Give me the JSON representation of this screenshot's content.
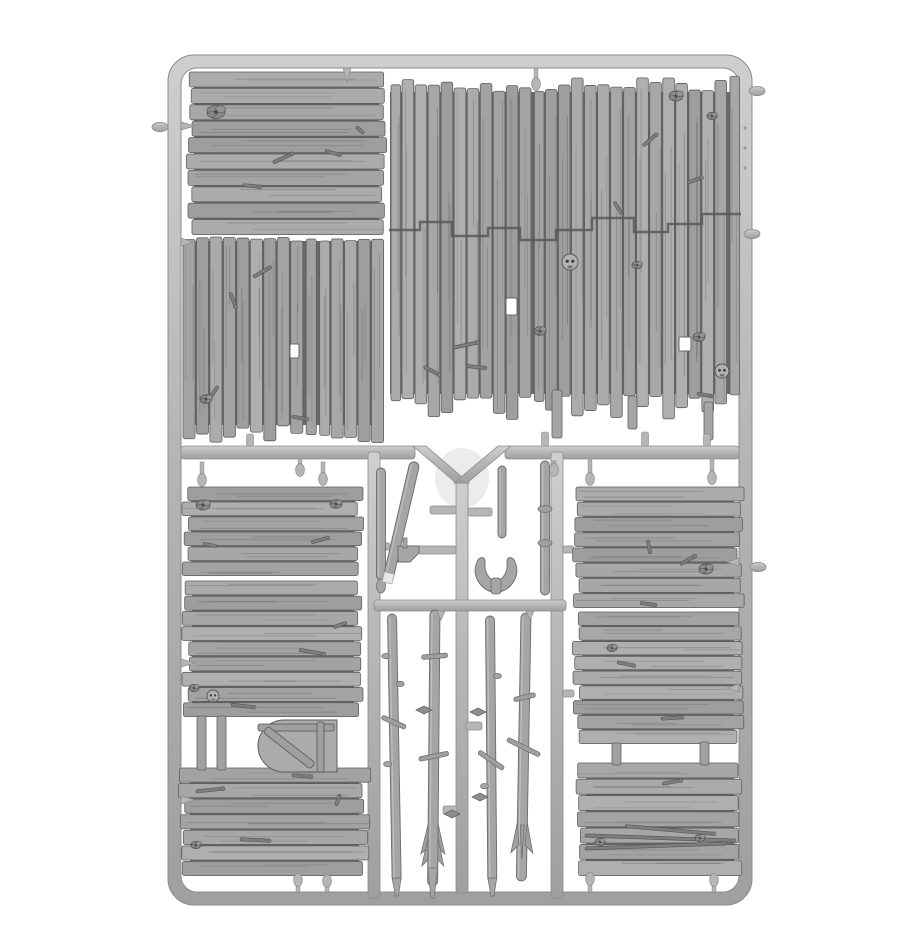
{
  "meta": {
    "alt": "Grey plastic model sprue containing weathered wooden plank wall panels, a round-top door and branch stick parts",
    "width": 920,
    "height": 950
  },
  "palette": {
    "bg": "#ffffff",
    "metal": "#b6b6b6",
    "metal_hi": "#cfcfcf",
    "metal_lo": "#9f9f9f",
    "metal_stroke": "#8b8b8b",
    "plank": "#a7a7a7",
    "plank_dark": "#696969",
    "seam": "#585858",
    "grain": "#3f3f3f",
    "stick": "#a5a5a5",
    "stick_stroke": "#6b6b6b",
    "detail": "#8c8c8c",
    "detail_stroke": "#545454",
    "hole": "#ffffff",
    "mold_mark": "#e2e2e2",
    "skull": "#b2b2b2"
  },
  "frame": {
    "x": 168,
    "y": 55,
    "w": 584,
    "h": 850,
    "r": 26,
    "t": 13
  },
  "mold_mark": {
    "cx": 462,
    "cy": 478,
    "rx": 27,
    "ry": 30
  },
  "runners": [
    {
      "id": "mid-left",
      "x": 181,
      "y": 446,
      "w": 234,
      "h": 13
    },
    {
      "id": "mid-right",
      "x": 505,
      "y": 446,
      "w": 234,
      "h": 13
    },
    {
      "id": "center-vertical",
      "x": 456,
      "y": 478,
      "w": 12,
      "h": 415
    },
    {
      "id": "left-vertical",
      "x": 368,
      "y": 452,
      "w": 12,
      "h": 446
    },
    {
      "id": "right-vertical",
      "x": 551,
      "y": 452,
      "w": 12,
      "h": 446
    },
    {
      "id": "mid-lower",
      "x": 374,
      "y": 600,
      "w": 192,
      "h": 11
    }
  ],
  "v_arms": [
    [
      413,
      446,
      426,
      446,
      469,
      483,
      456,
      483
    ],
    [
      498,
      446,
      511,
      446,
      467,
      483,
      454,
      483
    ]
  ],
  "crossbars": [
    [
      430,
      506,
      26,
      8
    ],
    [
      468,
      508,
      24,
      8
    ],
    [
      418,
      546,
      38,
      8
    ],
    [
      466,
      722,
      16,
      8
    ],
    [
      443,
      806,
      14,
      8
    ],
    [
      563,
      546,
      11,
      7
    ],
    [
      563,
      690,
      11,
      7
    ],
    [
      380,
      543,
      10,
      7
    ]
  ],
  "panels": [
    {
      "id": "top-left",
      "x": 188,
      "y": 72,
      "w": 197,
      "h": 164,
      "orient": "h",
      "planks": 10,
      "ragA": 6,
      "ragB": 6,
      "seed": 11
    },
    {
      "id": "mid-left",
      "x": 183,
      "y": 237,
      "w": 202,
      "h": 206,
      "orient": "v",
      "planks": 15,
      "ragA": 4,
      "ragB": 18,
      "seed": 22
    },
    {
      "id": "large-right",
      "x": 389,
      "y": 76,
      "w": 352,
      "h": 344,
      "orient": "v",
      "planks": 27,
      "ragA": 16,
      "ragB": 26,
      "seed": 33
    },
    {
      "id": "lower-left-top",
      "x": 184,
      "y": 487,
      "w": 178,
      "h": 90,
      "orient": "h",
      "planks": 6,
      "ragA": 7,
      "ragB": 7,
      "seed": 44
    },
    {
      "id": "lower-left-mid",
      "x": 184,
      "y": 581,
      "w": 178,
      "h": 137,
      "orient": "h",
      "planks": 9,
      "ragA": 8,
      "ragB": 8,
      "seed": 55
    },
    {
      "id": "lower-left-bottom",
      "x": 181,
      "y": 768,
      "w": 187,
      "h": 109,
      "orient": "h",
      "planks": 7,
      "ragA": 9,
      "ragB": 9,
      "seed": 66
    },
    {
      "id": "lower-right-top",
      "x": 575,
      "y": 487,
      "w": 167,
      "h": 122,
      "orient": "h",
      "planks": 8,
      "ragA": 8,
      "ragB": 8,
      "seed": 77
    },
    {
      "id": "lower-right-mid",
      "x": 574,
      "y": 612,
      "w": 168,
      "h": 133,
      "orient": "h",
      "planks": 9,
      "ragA": 8,
      "ragB": 8,
      "seed": 88
    },
    {
      "id": "lower-right-bottom",
      "x": 578,
      "y": 763,
      "w": 164,
      "h": 114,
      "orient": "h",
      "planks": 7,
      "ragA": 8,
      "ragB": 8,
      "seed": 99
    }
  ],
  "seam": {
    "points": "389,230 420,230 420,222 452,222 452,236 488,236 488,228 520,228 520,240 556,240 556,230 592,230 592,218 634,218 634,232 668,232 668,224 702,224 702,214 741,214"
  },
  "tails": [
    [
      552,
      390,
      10,
      48
    ],
    [
      628,
      396,
      9,
      33
    ],
    [
      704,
      402,
      9,
      38
    ]
  ],
  "posts": [
    [
      197,
      716,
      9,
      54
    ],
    [
      217,
      716,
      9,
      54
    ],
    [
      612,
      743,
      9,
      22
    ],
    [
      700,
      742,
      9,
      23
    ]
  ],
  "door": {
    "path": "M337,720 H284 A26,26 0 0 0 284,772 H337 Z",
    "battens": [
      [
        258,
        724,
        76,
        7
      ],
      [
        317,
        722,
        7,
        50
      ]
    ],
    "diag": {
      "x": 268,
      "y": 726,
      "len": 60,
      "w": 8,
      "ang": 38
    }
  },
  "sticks": [
    {
      "id": "stick-u1",
      "x": 381,
      "y": 468,
      "len": 112,
      "w": 9,
      "ang": 0,
      "tip": "drop"
    },
    {
      "id": "stick-u2",
      "x": 415,
      "y": 462,
      "len": 124,
      "w": 10,
      "ang": 13,
      "tip": "white"
    },
    {
      "id": "stick-u3",
      "x": 502,
      "y": 466,
      "len": 72,
      "w": 8,
      "ang": 0
    },
    {
      "id": "stick-u4",
      "x": 545,
      "y": 461,
      "len": 134,
      "w": 9,
      "ang": 0,
      "bands": [
        48,
        82
      ]
    },
    {
      "id": "stick-l1",
      "x": 392,
      "y": 614,
      "len": 268,
      "w": 9,
      "ang": -1,
      "knobs": [
        [
          42,
          -1
        ],
        [
          70,
          1
        ],
        [
          150,
          -1
        ]
      ],
      "bars": [
        [
          108,
          26,
          25
        ]
      ],
      "tip": "taper"
    },
    {
      "id": "stick-l2",
      "x": 435,
      "y": 610,
      "len": 276,
      "w": 10,
      "ang": 0.5,
      "bars": [
        [
          46,
          26,
          -5
        ],
        [
          146,
          30,
          -12
        ]
      ],
      "fletch": {
        "dy": 214,
        "type": "arrow"
      }
    },
    {
      "id": "stick-l3",
      "x": 490,
      "y": 616,
      "len": 266,
      "w": 9,
      "ang": -0.5,
      "knobs": [
        [
          60,
          1
        ],
        [
          170,
          -1
        ]
      ],
      "bars": [
        [
          144,
          30,
          35
        ]
      ],
      "tip": "taper"
    },
    {
      "id": "stick-l4",
      "x": 526,
      "y": 613,
      "len": 268,
      "w": 10,
      "ang": 1,
      "bars": [
        [
          84,
          22,
          -15
        ],
        [
          134,
          36,
          25
        ]
      ],
      "fletch": {
        "dy": 206,
        "type": "claw"
      }
    }
  ],
  "horn": {
    "left": "M492,592 C481,589 471,576 477,562 C479,556 486,556 485,563 C484,572 489,579 495,582 Z",
    "right": "M500,592 C511,589 521,576 515,562 C513,556 506,556 507,563 C508,572 503,579 497,582 Z",
    "stem": [
      491,
      578,
      10,
      16
    ]
  },
  "axe": {
    "body": "M398,546 h21 v7 l-9,9 h-12 z",
    "haft": [
      403,
      538,
      4,
      10
    ]
  },
  "pegs": [
    {
      "x": 347,
      "y": 68,
      "dir": "d",
      "len": 14,
      "t": "spike"
    },
    {
      "x": 536,
      "y": 68,
      "dir": "d",
      "len": 20,
      "t": "drop"
    },
    {
      "x": 181,
      "y": 126,
      "dir": "r",
      "len": 14,
      "t": "spike"
    },
    {
      "x": 181,
      "y": 242,
      "dir": "r",
      "len": 12,
      "t": "spike"
    },
    {
      "x": 181,
      "y": 663,
      "dir": "r",
      "len": 14,
      "t": "spike"
    },
    {
      "x": 181,
      "y": 800,
      "dir": "r",
      "len": 14,
      "t": "spike"
    },
    {
      "x": 739,
      "y": 562,
      "dir": "l",
      "len": 12,
      "t": "spike"
    },
    {
      "x": 739,
      "y": 688,
      "dir": "l",
      "len": 12,
      "t": "spike"
    },
    {
      "x": 202,
      "y": 462,
      "dir": "d",
      "len": 22,
      "t": "drop"
    },
    {
      "x": 323,
      "y": 462,
      "dir": "d",
      "len": 21,
      "t": "drop"
    },
    {
      "x": 590,
      "y": 460,
      "dir": "d",
      "len": 23,
      "t": "drop"
    },
    {
      "x": 712,
      "y": 460,
      "dir": "d",
      "len": 22,
      "t": "drop"
    },
    {
      "x": 300,
      "y": 459,
      "dir": "d",
      "len": 15,
      "t": "drop"
    },
    {
      "x": 554,
      "y": 461,
      "dir": "d",
      "len": 13,
      "t": "drop"
    },
    {
      "x": 250,
      "y": 446,
      "dir": "u",
      "len": 12,
      "t": "stub"
    },
    {
      "x": 545,
      "y": 446,
      "dir": "u",
      "len": 14,
      "t": "stub"
    },
    {
      "x": 645,
      "y": 446,
      "dir": "u",
      "len": 14,
      "t": "stub"
    },
    {
      "x": 707,
      "y": 446,
      "dir": "u",
      "len": 12,
      "t": "stub"
    },
    {
      "x": 298,
      "y": 892,
      "dir": "u",
      "len": 16,
      "t": "drop"
    },
    {
      "x": 327,
      "y": 892,
      "dir": "u",
      "len": 15,
      "t": "drop"
    },
    {
      "x": 590,
      "y": 892,
      "dir": "u",
      "len": 17,
      "t": "drop"
    },
    {
      "x": 714,
      "y": 892,
      "dir": "u",
      "len": 16,
      "t": "drop"
    },
    {
      "x": 441,
      "y": 611,
      "dir": "d",
      "len": 9,
      "t": "spike"
    },
    {
      "x": 530,
      "y": 611,
      "dir": "d",
      "len": 9,
      "t": "spike"
    }
  ],
  "nubs": [
    [
      757,
      91
    ],
    [
      752,
      234
    ],
    [
      758,
      567
    ],
    [
      160,
      127
    ]
  ],
  "frame_marks": [
    [
      745,
      128
    ],
    [
      745,
      148
    ],
    [
      745,
      168
    ]
  ],
  "leaves": [
    [
      478,
      712
    ],
    [
      452,
      814
    ],
    [
      480,
      797
    ],
    [
      424,
      710
    ]
  ],
  "decor": [
    {
      "t": "knot",
      "x": 216,
      "y": 112,
      "r": 9
    },
    {
      "t": "twig",
      "x": 283,
      "y": 158,
      "len": 22,
      "ang": -25
    },
    {
      "t": "twig",
      "x": 333,
      "y": 153,
      "len": 16,
      "ang": 15
    },
    {
      "t": "twig",
      "x": 252,
      "y": 186,
      "len": 18,
      "ang": 6
    },
    {
      "t": "twig",
      "x": 360,
      "y": 130,
      "len": 10,
      "ang": 40
    },
    {
      "t": "twig",
      "x": 262,
      "y": 272,
      "len": 20,
      "ang": -30
    },
    {
      "t": "twig",
      "x": 233,
      "y": 300,
      "len": 16,
      "ang": 70
    },
    {
      "t": "hole",
      "x": 290,
      "y": 344,
      "w": 9,
      "h": 14
    },
    {
      "t": "twig",
      "x": 214,
      "y": 392,
      "len": 14,
      "ang": -55
    },
    {
      "t": "knot",
      "x": 206,
      "y": 399,
      "r": 6
    },
    {
      "t": "twig",
      "x": 300,
      "y": 418,
      "len": 16,
      "ang": 10
    },
    {
      "t": "knot",
      "x": 676,
      "y": 96,
      "r": 7
    },
    {
      "t": "twig",
      "x": 650,
      "y": 140,
      "len": 18,
      "ang": -40
    },
    {
      "t": "skull",
      "x": 570,
      "y": 262,
      "r": 8
    },
    {
      "t": "skull",
      "x": 722,
      "y": 371,
      "r": 7
    },
    {
      "t": "knot",
      "x": 699,
      "y": 337,
      "r": 6
    },
    {
      "t": "hole",
      "x": 506,
      "y": 298,
      "w": 11,
      "h": 17
    },
    {
      "t": "hole",
      "x": 679,
      "y": 337,
      "w": 12,
      "h": 14
    },
    {
      "t": "twig",
      "x": 466,
      "y": 345,
      "len": 26,
      "ang": -12
    },
    {
      "t": "twig",
      "x": 476,
      "y": 367,
      "len": 20,
      "ang": 6
    },
    {
      "t": "knot",
      "x": 540,
      "y": 331,
      "r": 6
    },
    {
      "t": "twig",
      "x": 432,
      "y": 371,
      "len": 18,
      "ang": 28
    },
    {
      "t": "twig",
      "x": 618,
      "y": 208,
      "len": 14,
      "ang": 60
    },
    {
      "t": "knot",
      "x": 712,
      "y": 116,
      "r": 5
    },
    {
      "t": "twig",
      "x": 695,
      "y": 180,
      "len": 16,
      "ang": -20
    },
    {
      "t": "knot",
      "x": 637,
      "y": 265,
      "r": 5
    },
    {
      "t": "twig",
      "x": 705,
      "y": 395,
      "len": 16,
      "ang": 10
    },
    {
      "t": "knot",
      "x": 203,
      "y": 505,
      "r": 7
    },
    {
      "t": "knot",
      "x": 336,
      "y": 504,
      "r": 6
    },
    {
      "t": "twig",
      "x": 320,
      "y": 540,
      "len": 18,
      "ang": -15
    },
    {
      "t": "twig",
      "x": 210,
      "y": 545,
      "len": 14,
      "ang": 10
    },
    {
      "t": "twig",
      "x": 312,
      "y": 652,
      "len": 26,
      "ang": 10
    },
    {
      "t": "twig",
      "x": 340,
      "y": 625,
      "len": 14,
      "ang": -20
    },
    {
      "t": "skull",
      "x": 213,
      "y": 696,
      "r": 6
    },
    {
      "t": "twig",
      "x": 243,
      "y": 706,
      "len": 24,
      "ang": 6
    },
    {
      "t": "knot",
      "x": 194,
      "y": 688,
      "r": 5
    },
    {
      "t": "twig",
      "x": 210,
      "y": 790,
      "len": 28,
      "ang": -6
    },
    {
      "t": "twig",
      "x": 302,
      "y": 776,
      "len": 20,
      "ang": 4
    },
    {
      "t": "knot",
      "x": 196,
      "y": 845,
      "r": 5
    },
    {
      "t": "twig",
      "x": 255,
      "y": 840,
      "len": 30,
      "ang": 3
    },
    {
      "t": "twig",
      "x": 338,
      "y": 800,
      "len": 12,
      "ang": -70
    },
    {
      "t": "twig",
      "x": 649,
      "y": 547,
      "len": 14,
      "ang": 80
    },
    {
      "t": "knot",
      "x": 706,
      "y": 569,
      "r": 7
    },
    {
      "t": "twig",
      "x": 688,
      "y": 560,
      "len": 18,
      "ang": -30
    },
    {
      "t": "twig",
      "x": 648,
      "y": 604,
      "len": 16,
      "ang": 8
    },
    {
      "t": "twig",
      "x": 672,
      "y": 718,
      "len": 22,
      "ang": -4
    },
    {
      "t": "knot",
      "x": 612,
      "y": 648,
      "r": 5
    },
    {
      "t": "twig",
      "x": 626,
      "y": 664,
      "len": 18,
      "ang": 12
    },
    {
      "t": "twig",
      "x": 660,
      "y": 838,
      "len": 150,
      "ang": 2
    },
    {
      "t": "twig",
      "x": 655,
      "y": 846,
      "len": 140,
      "ang": -2
    },
    {
      "t": "twig",
      "x": 670,
      "y": 830,
      "len": 90,
      "ang": 5
    },
    {
      "t": "knot",
      "x": 600,
      "y": 842,
      "r": 5
    },
    {
      "t": "knot",
      "x": 700,
      "y": 838,
      "r": 5
    },
    {
      "t": "twig",
      "x": 672,
      "y": 782,
      "len": 20,
      "ang": -10
    }
  ]
}
